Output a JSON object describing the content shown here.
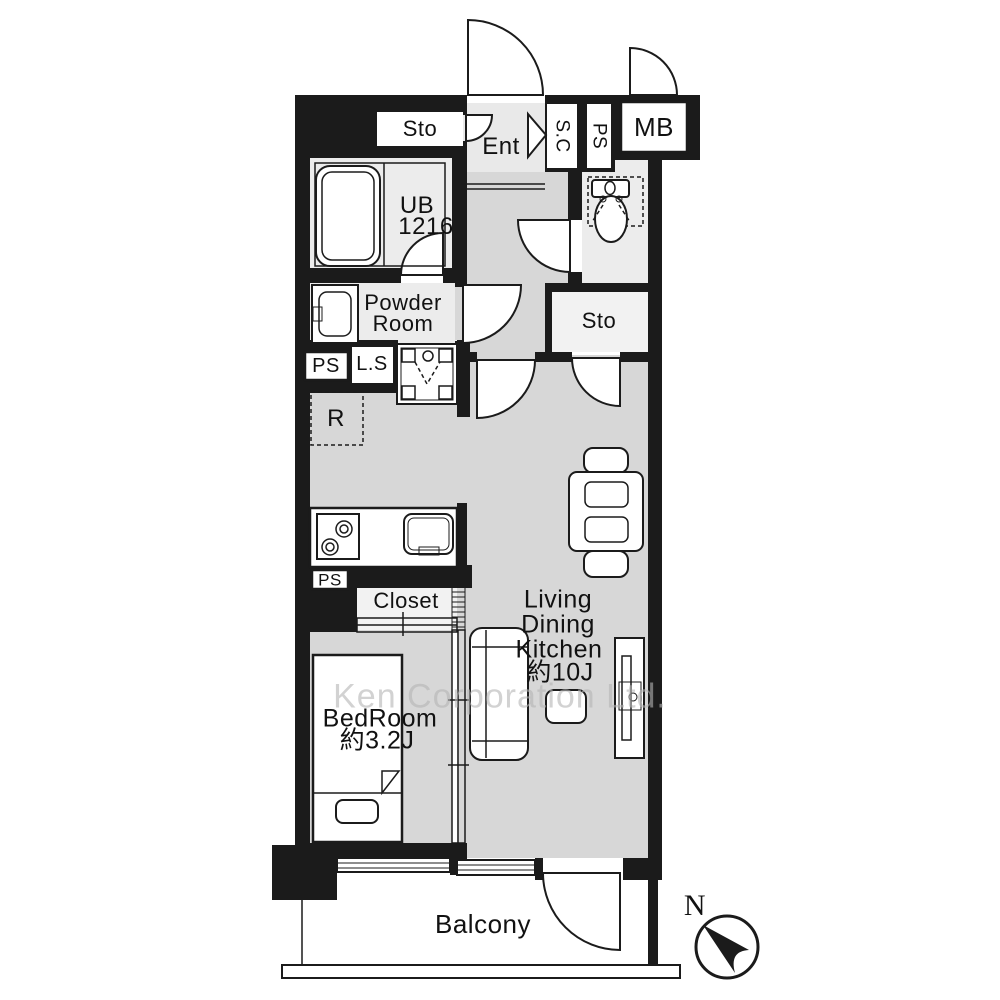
{
  "plan": {
    "watermark": "Ken Corporation Ltd.",
    "compass": {
      "north_label": "N"
    },
    "rooms": {
      "storage_top": "Sto",
      "entrance": "Ent",
      "shoe_closet": "S.C",
      "pipe_shaft_top": "PS",
      "meter_box": "MB",
      "unit_bath": {
        "line1": "UB",
        "line2": "1216"
      },
      "powder_room": {
        "line1": "Powder",
        "line2": "Room"
      },
      "pipe_shaft_left": "PS",
      "linen_storage": "L.S",
      "refrigerator_space": "R",
      "storage_hall": "Sto",
      "pipe_shaft_kitchen": "PS",
      "closet": "Closet",
      "bedroom": {
        "line1": "BedRoom",
        "line2": "約3.2J"
      },
      "living_dining_kitchen": {
        "line1": "Living",
        "line2": "Dining",
        "line3": "Kitchen",
        "line4": "約10J"
      },
      "balcony": "Balcony"
    },
    "colors": {
      "wall": "#1b1b1b",
      "line": "#1b1b1b",
      "floor_main": "#d7d7d7",
      "floor_wet": "#ececec",
      "floor_storage": "#f2f2f2",
      "floor_entry": "#e9e9e9",
      "label": "#111111",
      "watermark": "#b5b5b5"
    }
  }
}
